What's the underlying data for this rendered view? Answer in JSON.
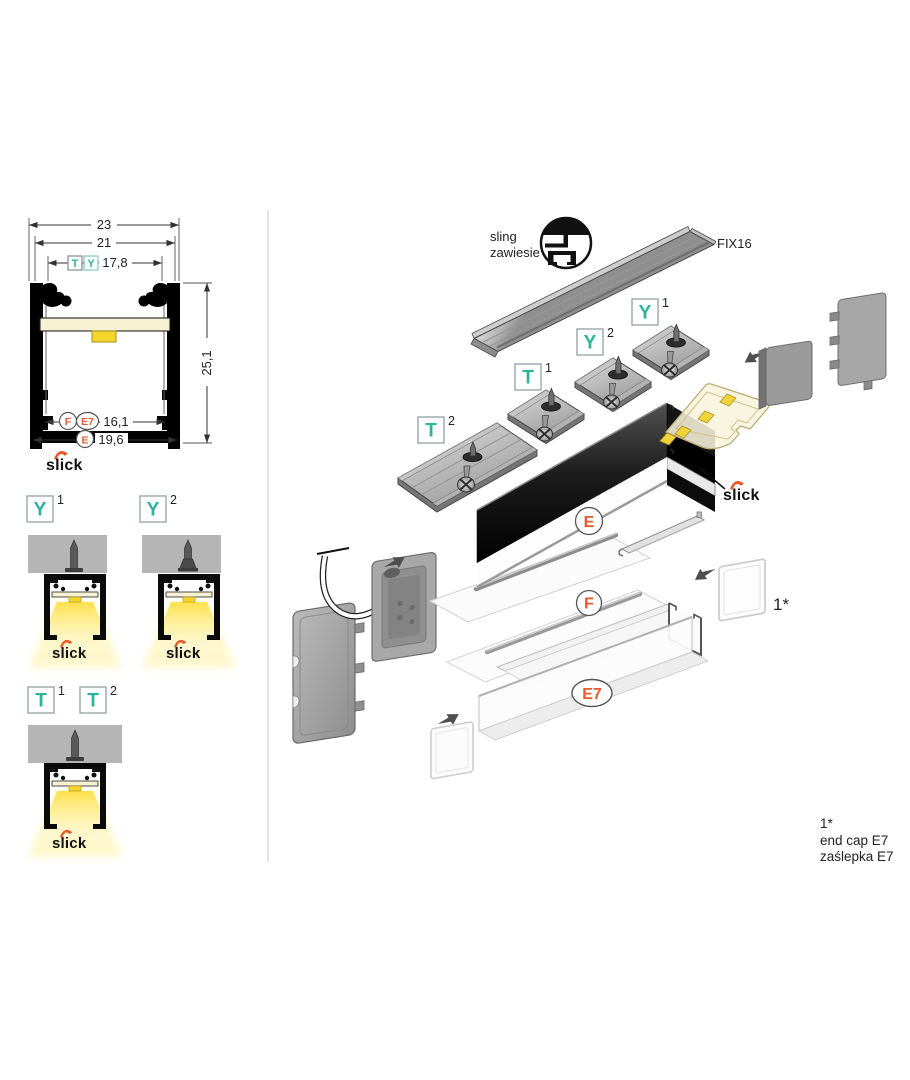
{
  "colors": {
    "teal": "#2bb499",
    "orange": "#e85a28"
  },
  "cross_section": {
    "dim_outer_width": "23",
    "dim_inner_width": "21",
    "dim_top_opening": "17,8",
    "dim_height": "25,1",
    "dim_bottom_inner": "16,1",
    "dim_bottom_outer": "19,6",
    "top_label_t": "T",
    "top_label_y": "Y",
    "bottom_label_f": "F",
    "bottom_label_e7": "E7",
    "bottom_label_e": "E",
    "brand": "slick"
  },
  "variants": {
    "y1_letter": "Y",
    "y1_sup": "1",
    "y2_letter": "Y",
    "y2_sup": "2",
    "t1_letter": "T",
    "t1_sup": "1",
    "t2_letter": "T",
    "t2_sup": "2",
    "brand": "slick"
  },
  "exploded": {
    "sling_line1": "sling",
    "sling_line2": "zawiesie",
    "rail_name": "FIX16",
    "y1_letter": "Y",
    "y1_sup": "1",
    "y2_letter": "Y",
    "y2_sup": "2",
    "t1_letter": "T",
    "t1_sup": "1",
    "t2_letter": "T",
    "t2_sup": "2",
    "label_e": "E",
    "label_f": "F",
    "label_e7": "E7",
    "brand": "slick",
    "endcap_ref": "1*"
  },
  "footnote": {
    "ref": "1*",
    "line1": "end cap E7",
    "line2": "zaślepka E7"
  }
}
